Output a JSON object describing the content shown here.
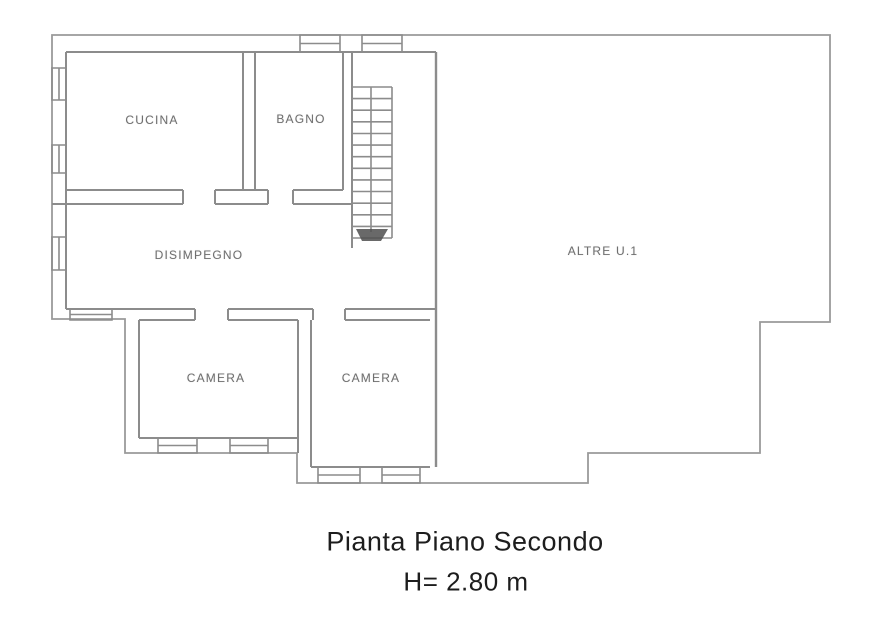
{
  "plan": {
    "rooms": [
      {
        "id": "cucina",
        "label": "CUCINA"
      },
      {
        "id": "bagno",
        "label": "BAGNO"
      },
      {
        "id": "disimpegno",
        "label": "DISIMPEGNO"
      },
      {
        "id": "altre-ui",
        "label": "ALTRE U.1"
      },
      {
        "id": "camera-1",
        "label": "CAMERA"
      },
      {
        "id": "camera-2",
        "label": "CAMERA"
      }
    ],
    "caption": {
      "title": "Pianta Piano Secondo",
      "height_note": "H= 2.80 m"
    },
    "colors": {
      "wall": "#8c8c8c",
      "room_label": "#6f6f6f",
      "caption_text": "#1d1d1d",
      "background": "#ffffff",
      "stair_arrow": "#4f4f4f"
    }
  }
}
